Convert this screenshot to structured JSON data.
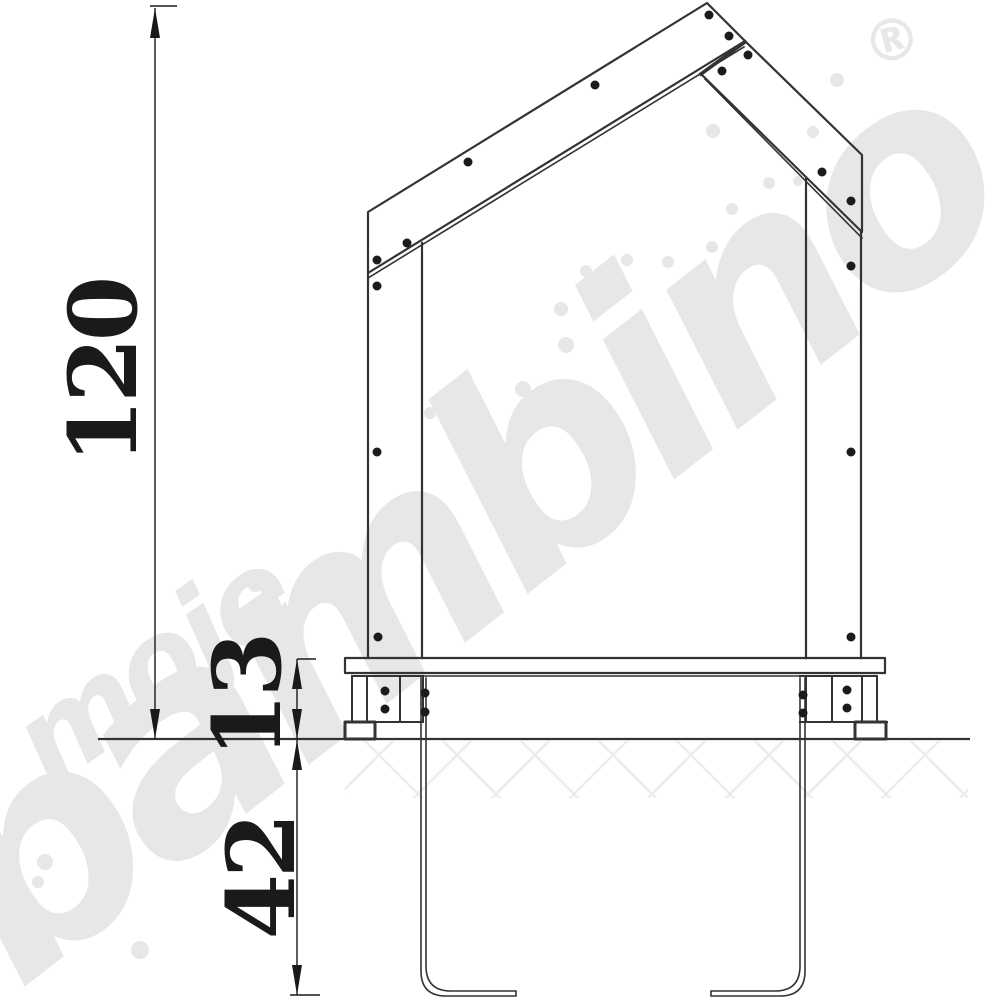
{
  "watermark": {
    "word_top": "moje",
    "word_bottom": "bambino",
    "registered_mark": "®"
  },
  "dimensions": {
    "overall_height": "120",
    "platform_height": "13",
    "anchor_depth": "42"
  },
  "colors": {
    "line": "#333333",
    "dim": "#1a1a1a",
    "watermark": "#e7e7e7",
    "hatch": "#ececec",
    "screw": "#1b1b1b"
  },
  "drawing": {
    "screws": [
      [
        709,
        15
      ],
      [
        729,
        36
      ],
      [
        748,
        55
      ],
      [
        722,
        71
      ],
      [
        595,
        85
      ],
      [
        468,
        162
      ],
      [
        407,
        243
      ],
      [
        377,
        260
      ],
      [
        377,
        286
      ],
      [
        377,
        452
      ],
      [
        378,
        637
      ],
      [
        822,
        172
      ],
      [
        851,
        201
      ],
      [
        851,
        266
      ],
      [
        851,
        452
      ],
      [
        851,
        637
      ],
      [
        385,
        691
      ],
      [
        385,
        709
      ],
      [
        425,
        693
      ],
      [
        425,
        712
      ],
      [
        847,
        690
      ],
      [
        847,
        708
      ],
      [
        803,
        695
      ],
      [
        803,
        713
      ]
    ],
    "watermark_dots": [
      [
        837,
        80,
        7
      ],
      [
        813,
        132,
        6
      ],
      [
        713,
        131,
        7
      ],
      [
        769,
        183,
        6
      ],
      [
        798,
        181,
        5
      ],
      [
        732,
        209,
        6
      ],
      [
        712,
        247,
        6
      ],
      [
        668,
        262,
        6
      ],
      [
        627,
        260,
        6
      ],
      [
        586,
        271,
        6
      ],
      [
        561,
        309,
        7
      ],
      [
        566,
        345,
        8
      ],
      [
        523,
        389,
        8
      ],
      [
        466,
        428,
        7
      ],
      [
        430,
        413,
        6
      ],
      [
        841,
        234,
        4
      ],
      [
        255,
        585,
        7
      ],
      [
        82,
        795,
        7
      ],
      [
        45,
        862,
        8
      ],
      [
        140,
        950,
        9
      ],
      [
        38,
        882,
        6
      ]
    ]
  }
}
